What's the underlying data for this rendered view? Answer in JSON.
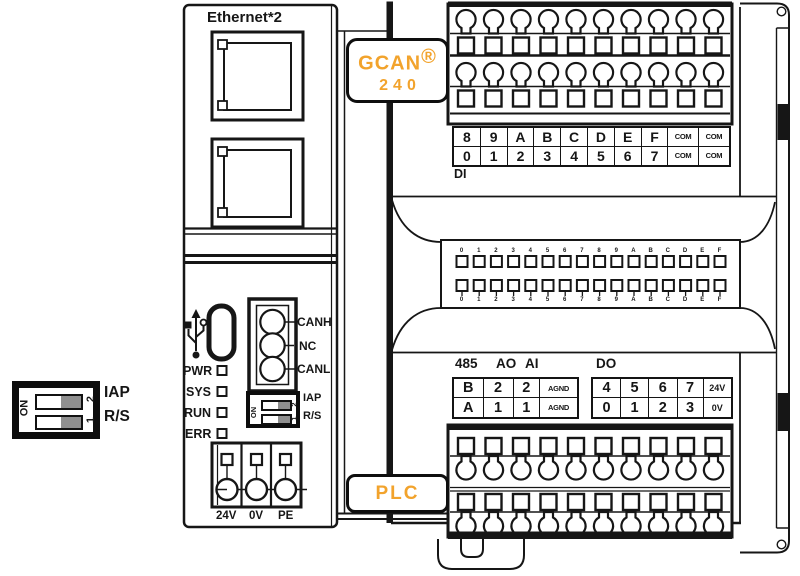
{
  "colors": {
    "accent": "#F2A32C",
    "line": "#161616",
    "dip_gray": "#8f8f8f"
  },
  "legend_dip": {
    "on": "ON",
    "pos_top": "2",
    "pos_bottom": "1",
    "label_top": "IAP",
    "label_bottom": "R/S"
  },
  "left_module": {
    "ethernet_label": "Ethernet*2",
    "leds": [
      "PWR",
      "SYS",
      "RUN",
      "ERR"
    ],
    "can_pins": [
      "CANH",
      "NC",
      "CANL"
    ],
    "dip": {
      "on": "ON",
      "pos_top": "2",
      "pos_bottom": "1",
      "label_top": "IAP",
      "label_bottom": "R/S"
    },
    "power_pins": [
      "24V",
      "0V",
      "PE"
    ]
  },
  "badges": {
    "logo_top": "GCAN",
    "logo_reg": "®",
    "logo_bottom": "240",
    "plc": "PLC"
  },
  "right_module": {
    "di": {
      "label": "DI",
      "rows": [
        [
          "8",
          "9",
          "A",
          "B",
          "C",
          "D",
          "E",
          "F",
          "COM",
          "COM"
        ],
        [
          "0",
          "1",
          "2",
          "3",
          "4",
          "5",
          "6",
          "7",
          "COM",
          "COM"
        ]
      ]
    },
    "bus": {
      "labels": "0123456789ABCDEF"
    },
    "io": {
      "headers": {
        "h485": "485",
        "ao": "AO",
        "ai": "AI",
        "do": "DO"
      },
      "analog_rows": [
        [
          "B",
          "2",
          "2",
          "AGND"
        ],
        [
          "A",
          "1",
          "1",
          "AGND"
        ]
      ],
      "do_rows": [
        [
          "4",
          "5",
          "6",
          "7",
          "24V"
        ],
        [
          "0",
          "1",
          "2",
          "3",
          "0V"
        ]
      ]
    }
  }
}
